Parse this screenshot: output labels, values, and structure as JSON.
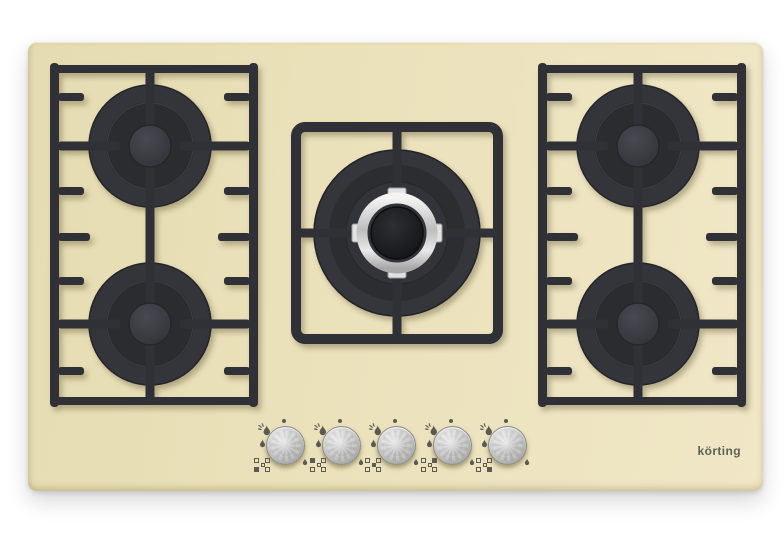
{
  "brand": {
    "logo_text": "körting",
    "logo_color": "#5f6055"
  },
  "colors": {
    "background": "#ffffff",
    "panel": "#ebe1bb",
    "grate": "#303136",
    "burner_ring": "#34353a",
    "chrome_ring": "#dcdcdc",
    "knob": "#c6c6c6",
    "icon": "#5b5b52"
  },
  "hob": {
    "burners": [
      {
        "id": "back-left",
        "size": "standard"
      },
      {
        "id": "front-left",
        "size": "standard"
      },
      {
        "id": "center",
        "size": "large-with-chrome-ring"
      },
      {
        "id": "back-right",
        "size": "standard"
      },
      {
        "id": "front-right",
        "size": "standard"
      }
    ],
    "knobs": [
      {
        "id": "knob-1",
        "controls": "front-left",
        "indicator_filled": "bl"
      },
      {
        "id": "knob-2",
        "controls": "back-left",
        "indicator_filled": "tl"
      },
      {
        "id": "knob-3",
        "controls": "center",
        "indicator_filled": "c"
      },
      {
        "id": "knob-4",
        "controls": "back-right",
        "indicator_filled": "tr"
      },
      {
        "id": "knob-5",
        "controls": "front-right",
        "indicator_filled": "br"
      }
    ],
    "knob_icons": [
      "flame-high-icon",
      "flame-low-icon",
      "off-dot-icon",
      "burner-position-icon",
      "drip-icon"
    ]
  }
}
